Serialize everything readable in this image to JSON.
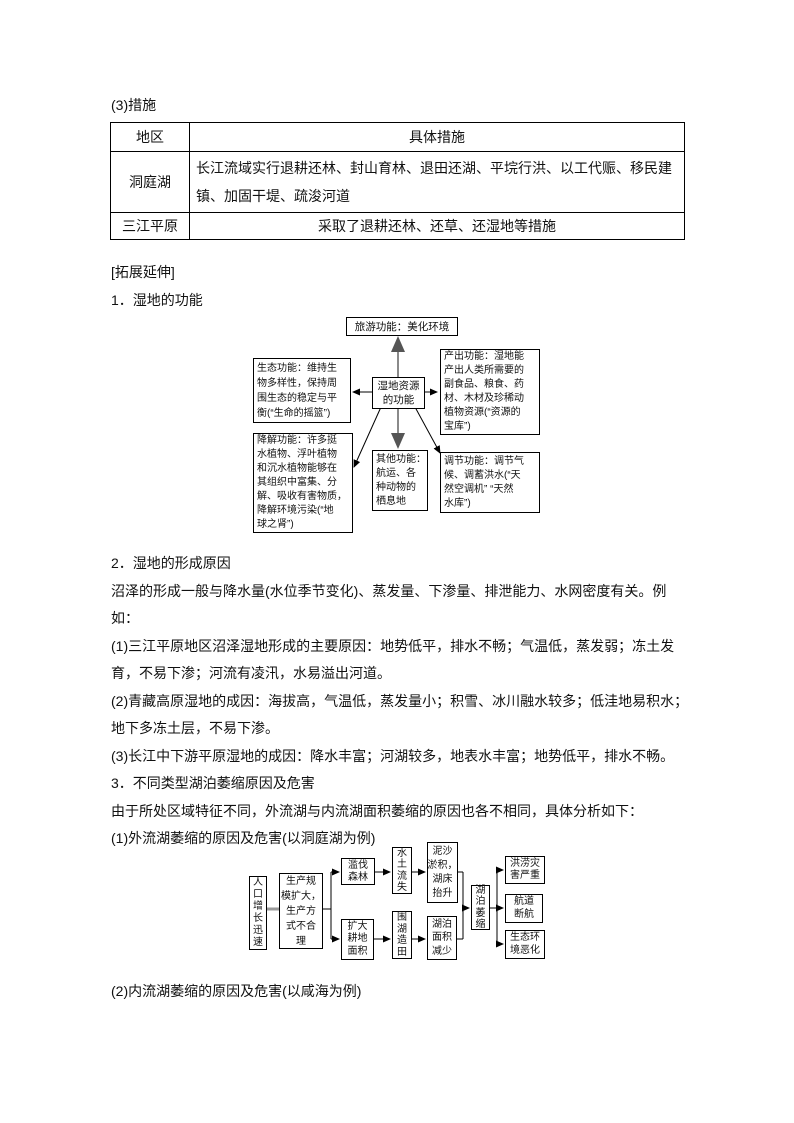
{
  "texts": {
    "measures_title": "(3)措施",
    "expand_title": "[拓展延伸]",
    "sec1_title": "1．湿地的功能",
    "sec2_title": "2．湿地的形成原因",
    "p_swamp": "沼泽的形成一般与降水量(水位季节变化)、蒸发量、下渗量、排泄能力、水网密度有关。例\n如：",
    "p_reason1": "(1)三江平原地区沼泽湿地形成的主要原因：地势低平，排水不畅；气温低，蒸发弱；冻土发\n育，不易下渗；河流有凌汛，水易溢出河道。",
    "p_reason2": "(2)青藏高原湿地的成因：海拔高，气温低，蒸发量小；积雪、冰川融水较多；低洼地易积水；\n地下多冻土层，不易下渗。",
    "p_reason3": "(3)长江中下游平原湿地的成因：降水丰富；河湖较多，地表水丰富；地势低平，排水不畅。",
    "sec3_title": "3．不同类型湖泊萎缩原因及危害",
    "p_intro": "由于所处区域特征不同，外流湖与内流湖面积萎缩的原因也各不相同，具体分析如下：",
    "outflow_title": "(1)外流湖萎缩的原因及危害(以洞庭湖为例)",
    "inflow_title": "(2)内流湖萎缩的原因及危害(以咸海为例)"
  },
  "table": {
    "headers": [
      "地区",
      "具体措施"
    ],
    "rows": [
      {
        "region": "洞庭湖",
        "measures": "长江流域实行退耕还林、封山育林、退田还湖、平垸行洪、以工代赈、移民建\n镇、加固干堤、疏浚河道"
      },
      {
        "region": "三江平原",
        "measures": "采取了退耕还林、还草、还湿地等措施"
      }
    ]
  },
  "wetland_functions_diagram": {
    "tourism": "旅游功能：美化环境",
    "center": "湿地资源\n的功能",
    "ecology": "生态功能：维持生\n物多样性，保持周\n围生态的稳定与平\n衡(“生命的摇篮”)",
    "output": "产出功能：湿地能\n产出人类所需要的\n副食品、粮食、药\n材、木材及珍稀动\n植物资源(“资源的\n宝库”)",
    "degrade": "降解功能：许多挺\n水植物、浮叶植物\n和沉水植物能够在\n其组织中富集、分\n解、吸收有害物质，\n降解环境污染(“地\n球之肾”)",
    "other": "其他功能：\n航运、各\n种动物的\n栖息地",
    "regulate": "调节功能：调节气\n候、调蓄洪水(“天\n然空调机” “天然\n水库”)"
  },
  "lake_shrink_diagram": {
    "population": "人\n口\n增\n长\n迅\n速",
    "production": "生产规\n模扩大，\n生产方\n式不合\n理",
    "deforest": "滥伐\n森林",
    "expand_farm": "扩大\n耕地\n面积",
    "soil_erosion": "水\n土\n流\n失",
    "reclaim": "围\n湖\n造\n田",
    "silt": "泥沙\n淤积，\n湖床\n抬升",
    "area_decrease": "湖泊\n面积\n减少",
    "lake_shrink": "湖\n泊\n萎\n缩",
    "flood": "洪涝灾\n害严重",
    "navigation": "航道\n断航",
    "eco_worse": "生态环\n境恶化"
  }
}
